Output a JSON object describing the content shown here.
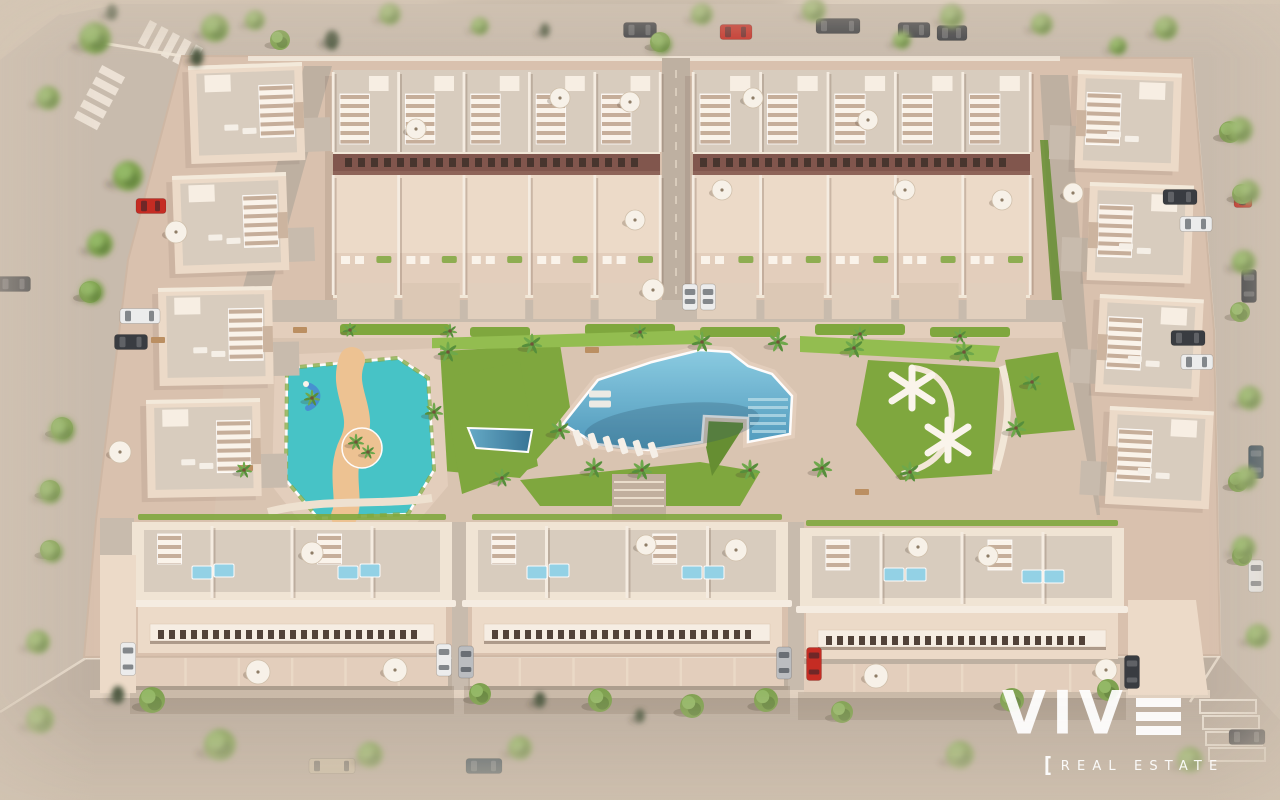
{
  "logo": {
    "brand": "VIVE",
    "brand_prefix": "VIV",
    "tagline_bracket": "[",
    "tagline": "REAL ESTATE"
  },
  "palette": {
    "terrain": "#d2c5b3",
    "terrain_light": "#e4d9c8",
    "terrain_dark": "#b3a591",
    "road": "#c7bbad",
    "road_dark": "#bcafa1",
    "curb": "#eee4d5",
    "plate": "#d8c1ae",
    "plate_light": "#e3cfbd",
    "park_pave": "#d9c4b2",
    "wall": "#eddcca",
    "wall_white": "#f8f1e6",
    "roof": "#d7cdbf",
    "accent_strip": "#7c5148",
    "strip_window": "#402e28",
    "facade_window": "#4a3c33",
    "grass": "#7aa638",
    "grass_light": "#8fbd4b",
    "grass_dark": "#5f8c2c",
    "pool_light": "#8fd2e8",
    "pool": "#59aed2",
    "pool_deep": "#3e8cb4",
    "kids_pool": "#3fc3c8",
    "sand": "#eec291",
    "tree": "#7aa04b",
    "tree_light": "#8fb862",
    "tree_dark": "#5d8038",
    "cypress": "#44523a",
    "white": "#faf7f1",
    "shadow": "rgba(80,60,45,0.30)",
    "car_dark": "#30353b",
    "car_white": "#eceff0",
    "car_silver": "#b9bdc1",
    "car_red": "#c3241c",
    "car_navy": "#27404f",
    "car_tan": "#cfc2a8",
    "logo_white": "rgba(255,255,255,0.93)"
  },
  "scene": {
    "outer_trees": [
      [
        95,
        38,
        16
      ],
      [
        215,
        28,
        14
      ],
      [
        128,
        176,
        15
      ],
      [
        100,
        244,
        13
      ],
      [
        48,
        98,
        12
      ],
      [
        62,
        430,
        13
      ],
      [
        50,
        492,
        12
      ],
      [
        52,
        552,
        11
      ],
      [
        92,
        292,
        12
      ],
      [
        38,
        642,
        12
      ],
      [
        255,
        20,
        10
      ],
      [
        1240,
        130,
        13
      ],
      [
        1248,
        192,
        12
      ],
      [
        1244,
        262,
        12
      ],
      [
        1250,
        398,
        12
      ],
      [
        1246,
        478,
        12
      ],
      [
        1244,
        548,
        12
      ],
      [
        1258,
        636,
        12
      ],
      [
        390,
        14,
        11
      ],
      [
        480,
        26,
        9
      ],
      [
        662,
        44,
        10
      ],
      [
        702,
        14,
        11
      ],
      [
        814,
        10,
        12
      ],
      [
        902,
        40,
        9
      ],
      [
        952,
        16,
        12
      ],
      [
        1042,
        24,
        11
      ],
      [
        1166,
        28,
        12
      ],
      [
        1118,
        46,
        9
      ],
      [
        220,
        745,
        16
      ],
      [
        370,
        755,
        13
      ],
      [
        520,
        748,
        12
      ],
      [
        960,
        755,
        14
      ],
      [
        1190,
        760,
        13
      ],
      [
        40,
        720,
        14
      ]
    ],
    "cypress_trees": [
      [
        197,
        57,
        9
      ],
      [
        332,
        40,
        10
      ],
      [
        112,
        12,
        8
      ],
      [
        545,
        30,
        7
      ],
      [
        118,
        695,
        9
      ],
      [
        540,
        700,
        8
      ],
      [
        640,
        716,
        7
      ]
    ],
    "street_trees": [
      [
        152,
        700,
        13
      ],
      [
        480,
        694,
        11
      ],
      [
        600,
        700,
        12
      ],
      [
        692,
        706,
        12
      ],
      [
        766,
        700,
        12
      ],
      [
        842,
        712,
        11
      ],
      [
        1012,
        700,
        12
      ],
      [
        1108,
        690,
        11
      ],
      [
        1230,
        132,
        11
      ],
      [
        1242,
        194,
        10
      ],
      [
        1240,
        312,
        10
      ],
      [
        1238,
        482,
        10
      ],
      [
        1242,
        556,
        10
      ],
      [
        90,
        292,
        11
      ],
      [
        62,
        428,
        11
      ],
      [
        50,
        490,
        10
      ],
      [
        50,
        550,
        10
      ],
      [
        280,
        40,
        10
      ],
      [
        660,
        42,
        10
      ]
    ],
    "palms": [
      [
        448,
        352,
        10
      ],
      [
        532,
        344,
        10
      ],
      [
        560,
        430,
        10
      ],
      [
        594,
        468,
        10
      ],
      [
        642,
        470,
        10
      ],
      [
        702,
        342,
        10
      ],
      [
        750,
        470,
        10
      ],
      [
        778,
        342,
        10
      ],
      [
        822,
        468,
        10
      ],
      [
        854,
        348,
        10
      ],
      [
        910,
        472,
        10
      ],
      [
        964,
        352,
        10
      ],
      [
        1016,
        428,
        10
      ],
      [
        502,
        478,
        9
      ],
      [
        434,
        412,
        9
      ],
      [
        356,
        442,
        8
      ],
      [
        368,
        452,
        7
      ],
      [
        312,
        398,
        8
      ],
      [
        1032,
        382,
        9
      ],
      [
        350,
        330,
        7
      ],
      [
        450,
        331,
        7
      ],
      [
        640,
        332,
        7
      ],
      [
        860,
        334,
        7
      ],
      [
        960,
        336,
        7
      ],
      [
        244,
        470,
        8
      ]
    ],
    "cars": [
      [
        640,
        30,
        "h",
        "dark",
        33
      ],
      [
        736,
        32,
        "h",
        "red",
        32
      ],
      [
        838,
        26,
        "h",
        "dark",
        44
      ],
      [
        914,
        30,
        "h",
        "dark",
        32
      ],
      [
        952,
        33,
        "h",
        "dark",
        30
      ],
      [
        140,
        316,
        "h",
        "white",
        40
      ],
      [
        131,
        342,
        "h",
        "dark",
        33
      ],
      [
        151,
        206,
        "h",
        "red",
        30
      ],
      [
        14,
        284,
        "h",
        "dark",
        33
      ],
      [
        1180,
        197,
        "h",
        "dark",
        34
      ],
      [
        1196,
        224,
        "h",
        "white",
        32
      ],
      [
        1249,
        286,
        "v",
        "dark",
        33
      ],
      [
        1188,
        338,
        "h",
        "dark",
        34
      ],
      [
        1197,
        362,
        "h",
        "white",
        32
      ],
      [
        1243,
        200,
        "h",
        "red",
        18
      ],
      [
        1256,
        462,
        "v",
        "navy",
        33
      ],
      [
        1256,
        576,
        "v",
        "white",
        32
      ],
      [
        1247,
        737,
        "h",
        "dark",
        36
      ],
      [
        128,
        659,
        "v",
        "white",
        33
      ],
      [
        444,
        660,
        "v",
        "white",
        32
      ],
      [
        466,
        662,
        "v",
        "silver",
        32
      ],
      [
        784,
        663,
        "v",
        "silver",
        32
      ],
      [
        814,
        664,
        "v",
        "red",
        33
      ],
      [
        690,
        297,
        "v",
        "white",
        26
      ],
      [
        708,
        297,
        "v",
        "white",
        26
      ],
      [
        1132,
        672,
        "v",
        "dark",
        33
      ],
      [
        332,
        766,
        "h",
        "tan",
        46
      ],
      [
        484,
        766,
        "h",
        "navy",
        36
      ]
    ],
    "umbrellas": [
      [
        312,
        553,
        11
      ],
      [
        258,
        672,
        12
      ],
      [
        736,
        550,
        11
      ],
      [
        876,
        676,
        12
      ],
      [
        1106,
        670,
        11
      ],
      [
        646,
        545,
        10
      ],
      [
        918,
        547,
        10
      ],
      [
        988,
        556,
        10
      ],
      [
        416,
        129,
        10
      ],
      [
        560,
        98,
        10
      ],
      [
        630,
        102,
        10
      ],
      [
        753,
        98,
        10
      ],
      [
        722,
        190,
        10
      ],
      [
        635,
        220,
        10
      ],
      [
        653,
        290,
        11
      ],
      [
        905,
        190,
        10
      ],
      [
        868,
        120,
        10
      ],
      [
        1002,
        200,
        10
      ],
      [
        176,
        232,
        11
      ],
      [
        120,
        452,
        11
      ],
      [
        1073,
        193,
        10
      ],
      [
        395,
        670,
        12
      ]
    ],
    "roof_pools": [
      [
        192,
        566
      ],
      [
        214,
        564
      ],
      [
        338,
        566
      ],
      [
        360,
        564
      ],
      [
        527,
        566
      ],
      [
        549,
        564
      ],
      [
        682,
        566
      ],
      [
        704,
        566
      ],
      [
        884,
        568
      ],
      [
        906,
        568
      ],
      [
        1022,
        570
      ],
      [
        1044,
        570
      ]
    ],
    "park_loungers": [
      [
        578,
        438
      ],
      [
        593,
        441
      ],
      [
        608,
        444
      ],
      [
        623,
        446
      ],
      [
        638,
        448
      ],
      [
        653,
        450
      ]
    ],
    "pool_loungers": [
      [
        600,
        394
      ],
      [
        600,
        404
      ]
    ],
    "window_rows": [
      {
        "x0": 158,
        "x1": 426,
        "y": 630,
        "step": 11,
        "w": 6,
        "h": 9,
        "color": "facade_window"
      },
      {
        "x0": 492,
        "x1": 760,
        "y": 630,
        "step": 11,
        "w": 6,
        "h": 9,
        "color": "facade_window"
      },
      {
        "x0": 826,
        "x1": 1094,
        "y": 636,
        "step": 11,
        "w": 6,
        "h": 9,
        "color": "facade_window"
      },
      {
        "x0": 345,
        "x1": 650,
        "y": 158,
        "step": 13,
        "w": 7,
        "h": 9,
        "color": "strip_window"
      },
      {
        "x0": 700,
        "x1": 1022,
        "y": 158,
        "step": 13,
        "w": 7,
        "h": 9,
        "color": "strip_window"
      }
    ],
    "x_pergolas": [
      [
        912,
        388
      ],
      [
        948,
        440
      ]
    ],
    "parking_bays": [
      [
        1200,
        700
      ],
      [
        1203,
        716
      ],
      [
        1206,
        732
      ],
      [
        1209,
        748
      ]
    ],
    "crosswalks": [
      {
        "x": 150,
        "y": 20,
        "angle": 28
      },
      {
        "x": 74,
        "y": 118,
        "angle": -62
      }
    ],
    "benches": [
      [
        300,
        330
      ],
      [
        592,
        350
      ],
      [
        862,
        492
      ],
      [
        246,
        468
      ],
      [
        158,
        340
      ]
    ],
    "townhouse_blocks": [
      {
        "x": 333,
        "y": 70,
        "w": 327,
        "units": 5
      },
      {
        "x": 693,
        "y": 70,
        "w": 337,
        "units": 5
      }
    ],
    "bottom_blocks": [
      {
        "x": 132,
        "y": 522,
        "w": 320
      },
      {
        "x": 466,
        "y": 522,
        "w": 322
      },
      {
        "x": 800,
        "y": 528,
        "w": 324
      }
    ],
    "left_villas": [
      {
        "x": 188,
        "y": 66,
        "rot": -2
      },
      {
        "x": 172,
        "y": 176,
        "rot": -2
      },
      {
        "x": 158,
        "y": 288,
        "rot": -1
      },
      {
        "x": 146,
        "y": 400,
        "rot": -1
      }
    ],
    "right_villas": [
      {
        "x": 1078,
        "y": 70,
        "rot": 2
      },
      {
        "x": 1090,
        "y": 182,
        "rot": 2
      },
      {
        "x": 1100,
        "y": 294,
        "rot": 3
      },
      {
        "x": 1110,
        "y": 406,
        "rot": 3
      }
    ]
  }
}
